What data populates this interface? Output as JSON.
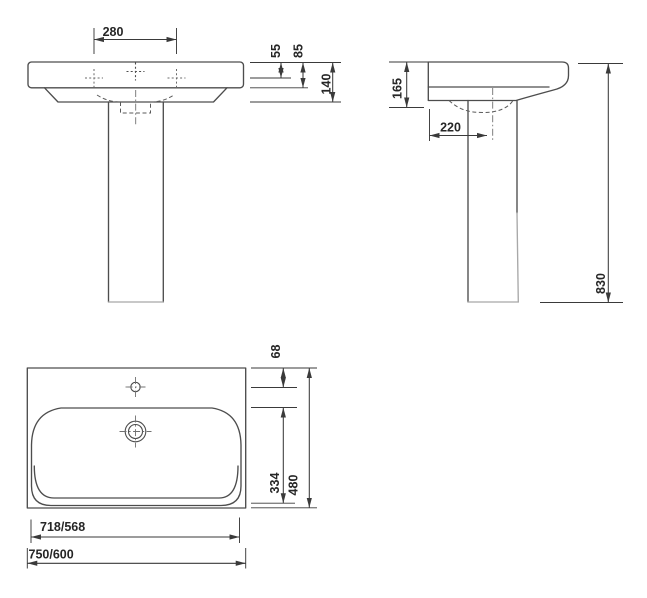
{
  "drawing": {
    "front_view": {
      "dim_tap_spacing": "280",
      "dim_rim_to_tap": "55",
      "dim_rim_height": "85",
      "dim_basin_height": "140"
    },
    "side_view": {
      "dim_front_height": "165",
      "dim_drain_offset": "220",
      "dim_total_height": "830"
    },
    "plan_view": {
      "dim_edge_to_tap": "68",
      "dim_bowl_depth": "334",
      "dim_total_depth": "480",
      "dim_bowl_width": "718/568",
      "dim_total_width": "750/600"
    },
    "colors": {
      "background": "#ffffff",
      "outline": "#4d4d4d",
      "light_outline": "#a8a8a8",
      "dimension_line": "#3a3a3a",
      "label_text": "#262626"
    }
  }
}
